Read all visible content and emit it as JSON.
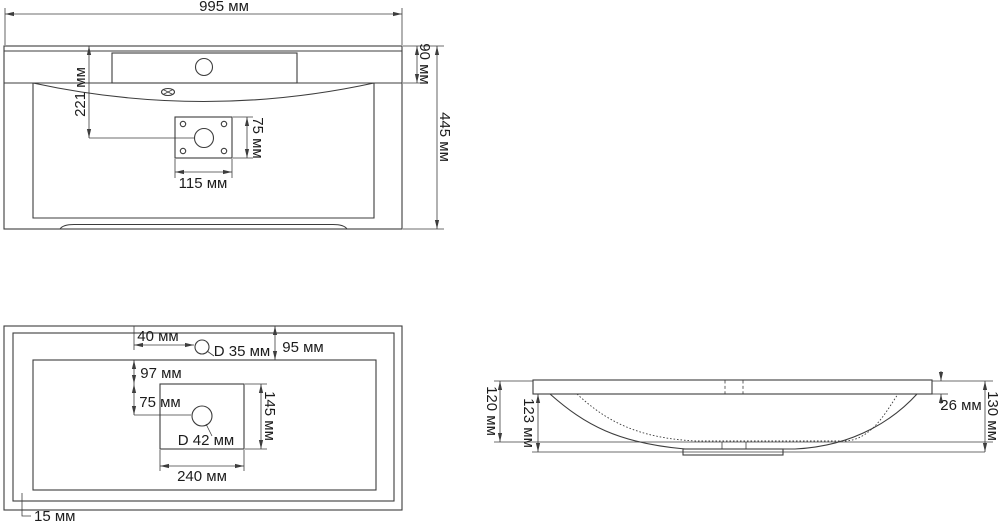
{
  "unit": "мм",
  "colors": {
    "line": "#3d3d3d",
    "text": "#1c1c1c",
    "background": "#ffffff"
  },
  "front_view": {
    "overall_width": "995 мм",
    "rim_to_bowl_height": "90 мм",
    "top_to_drain_depth": "221 мм",
    "plate_height": "75 мм",
    "plate_width": "115 мм",
    "overall_height": "445 мм"
  },
  "plan_view": {
    "faucet_offset": "40 мм",
    "faucet_hole_diameter": "D 35 мм",
    "edge_to_bowl": "95 мм",
    "bowl_to_recess": "97 мм",
    "recess_to_drain": "75 мм",
    "recess_depth": "145 мм",
    "drain_hole_diameter": "D 42 мм",
    "recess_width": "240 мм",
    "rim_width": "15 мм"
  },
  "side_view": {
    "bowl_depth": "120 мм",
    "body_depth": "123 мм",
    "rim_thickness": "26 мм",
    "overall_height": "130 мм"
  }
}
